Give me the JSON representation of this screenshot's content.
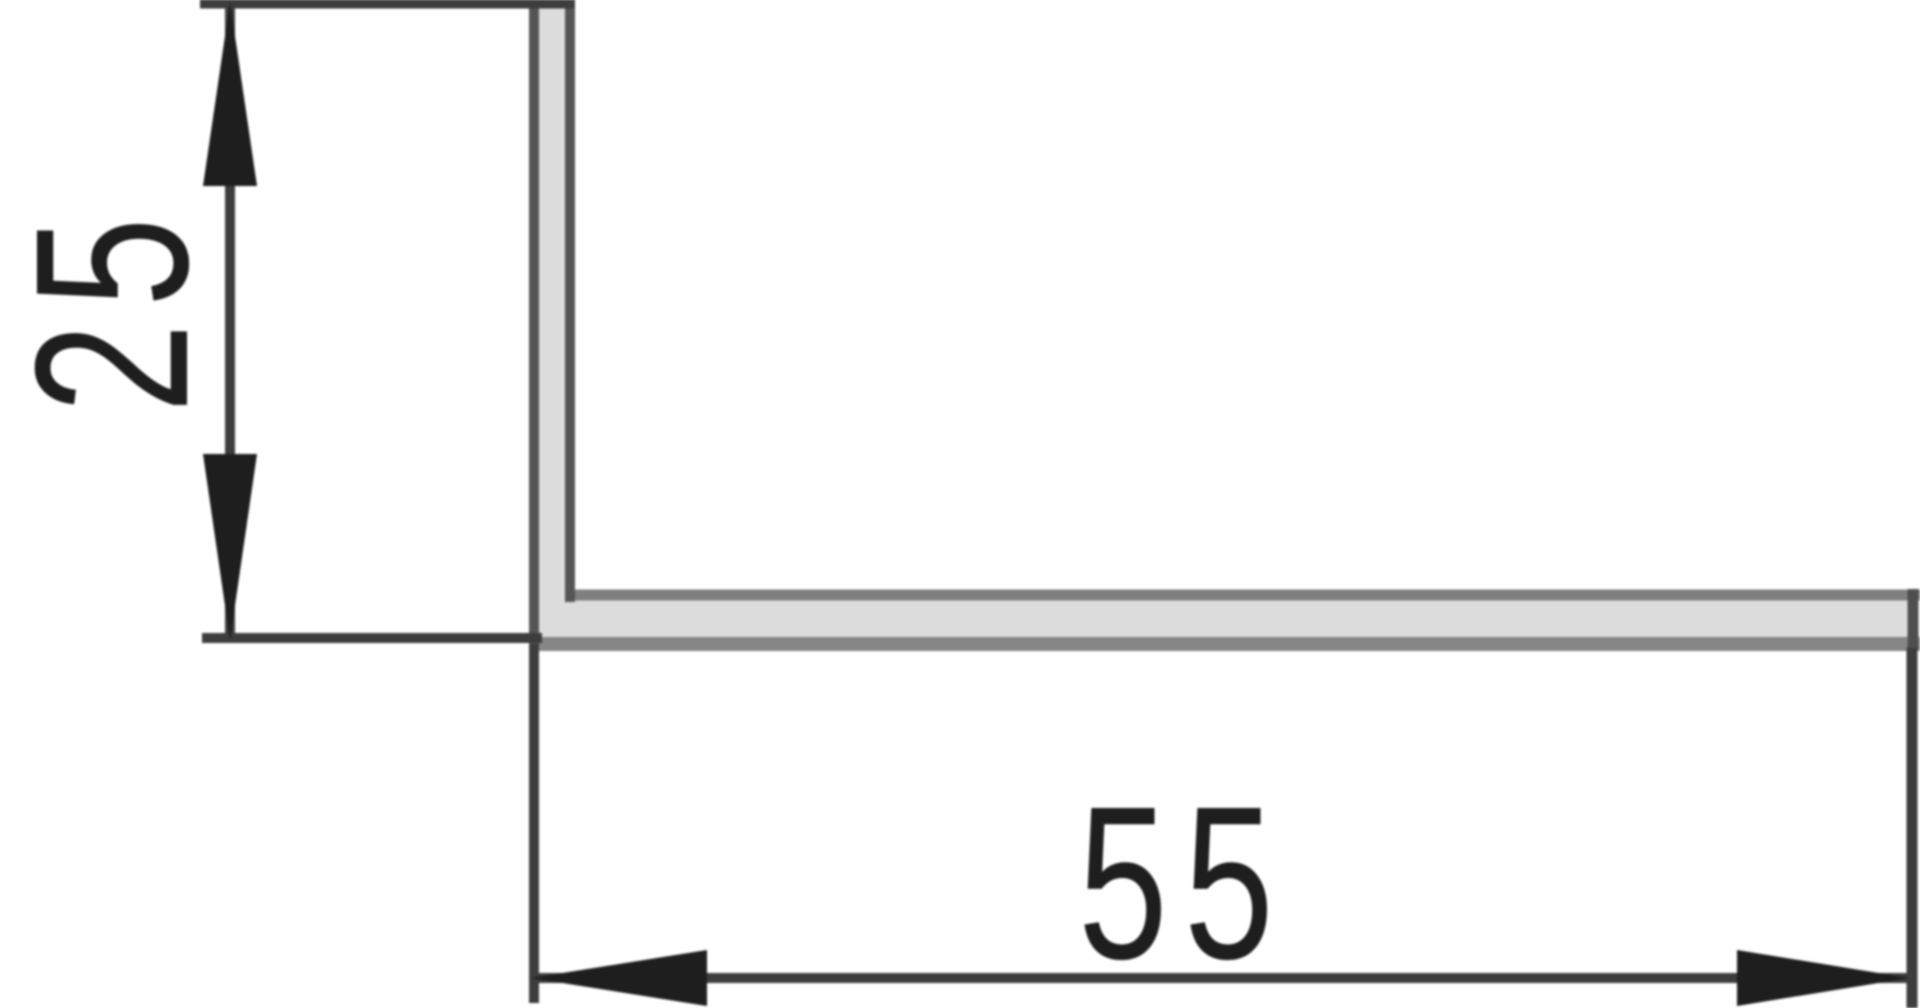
{
  "page": {
    "type": "technical-drawing",
    "subject": "L-angle profile cross-section with linear dimensions",
    "background": "#ffffff"
  },
  "dimensions": {
    "vertical": {
      "label": "25",
      "orientation": "vertical"
    },
    "horizontal": {
      "label": "55",
      "orientation": "horizontal"
    }
  },
  "colors": {
    "dimension_line": "#3d3d3d",
    "arrow_and_text": "#1e1e1e",
    "profile_fill": "#dcdcdc",
    "profile_dark_edge": "#555555",
    "profile_top_edge": "#7f7f7f",
    "profile_bottom_edge": "#868686"
  }
}
